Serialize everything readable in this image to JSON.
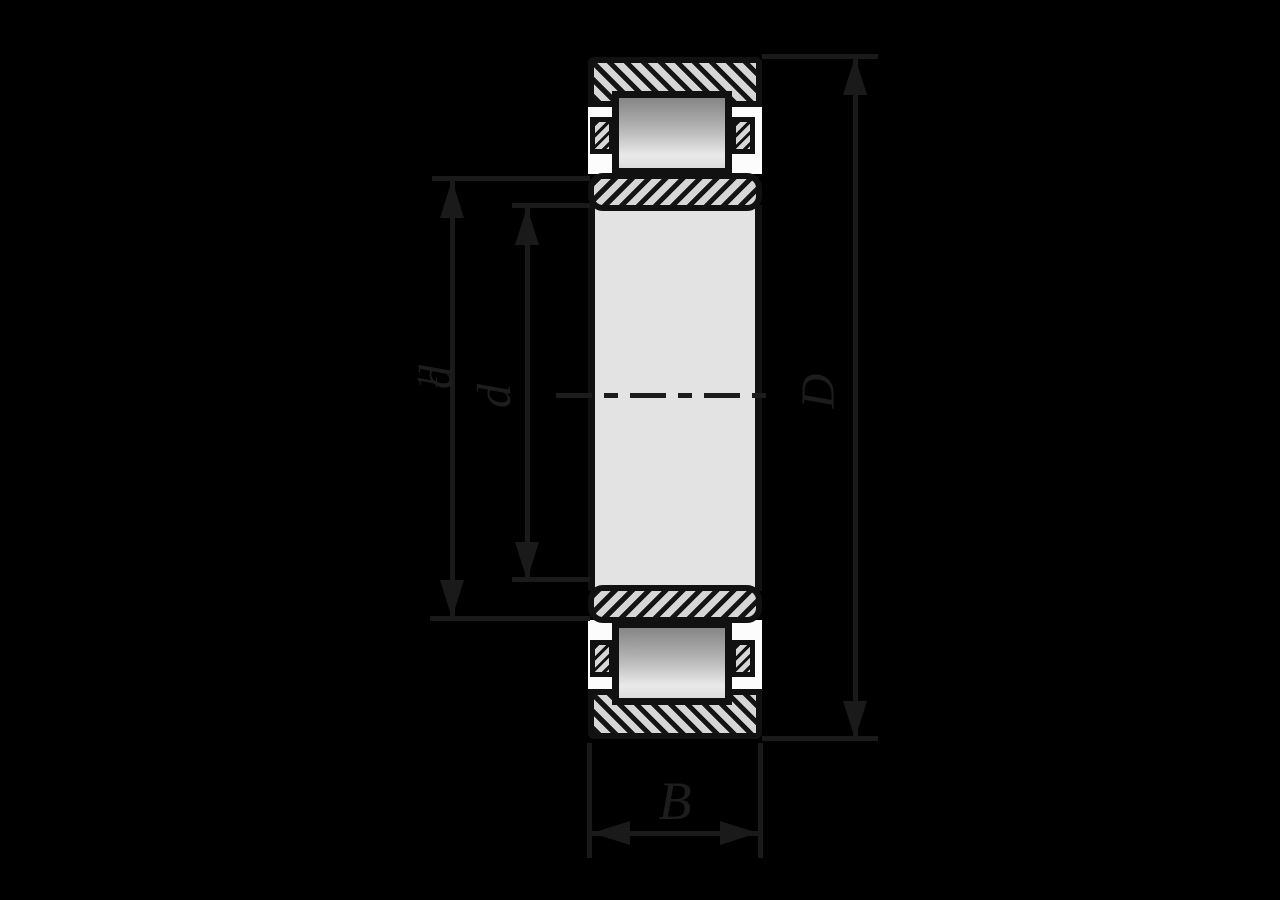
{
  "figure": {
    "title": "bearing-cross-section-dimension-diagram",
    "labels": {
      "d1": {
        "main": "d",
        "sub": "1"
      },
      "d": "d",
      "D": "D",
      "B": "B"
    },
    "colors": {
      "background": "#000000",
      "outline": "#111111",
      "hatch_fill": "#d6d6d6",
      "interior_white": "#fcfcfc",
      "shaft_fill": "#e3e3e3",
      "roller_gradient_top": "#868686",
      "roller_gradient_bottom": "#e9e9e9",
      "dimension_line": "#1a1a1a",
      "label_text": "#1d1d1d"
    }
  }
}
